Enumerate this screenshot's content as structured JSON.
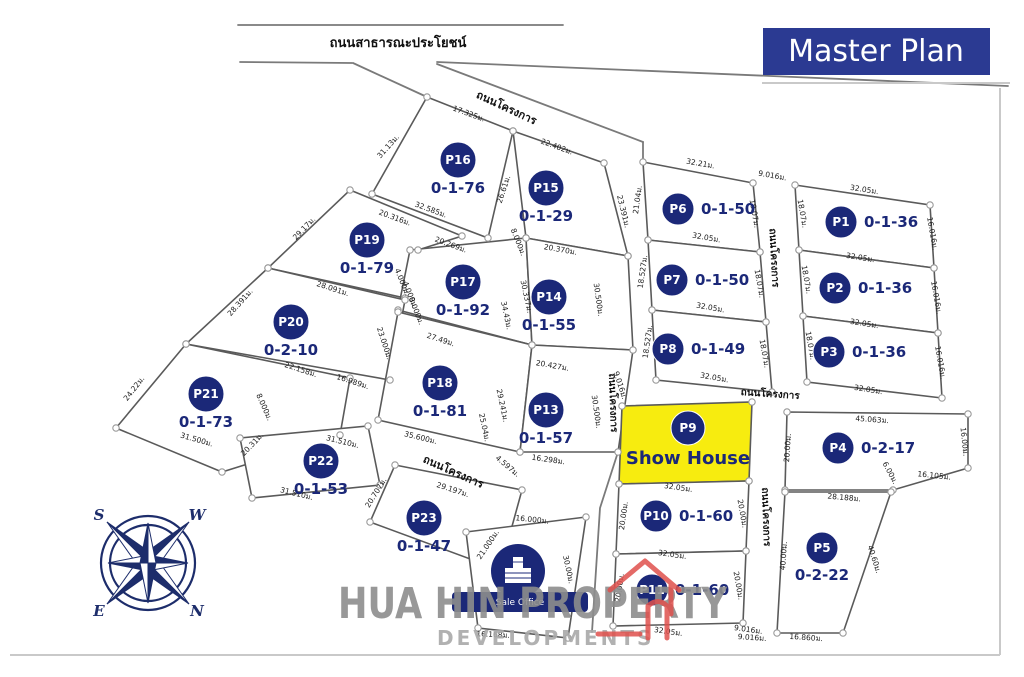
{
  "title": {
    "master_plan": "Master Plan"
  },
  "watermark": {
    "line1": "HUA HIN PROPERTY",
    "line2": "DEVELOPMENTS"
  },
  "sale_office": {
    "label": "Sale Office"
  },
  "compass": {
    "n": "N",
    "s": "S",
    "e": "E",
    "w": "W"
  },
  "colors": {
    "navy": "#1b2878",
    "yellow": "#f7ec0f",
    "box_blue": "#2b3a92",
    "red": "#e0514d"
  },
  "plots": {
    "P1": {
      "id": "P1",
      "area": "0-1-36"
    },
    "P2": {
      "id": "P2",
      "area": "0-1-36"
    },
    "P3": {
      "id": "P3",
      "area": "0-1-36"
    },
    "P4": {
      "id": "P4",
      "area": "0-2-17"
    },
    "P5": {
      "id": "P5",
      "area": "0-2-22"
    },
    "P6": {
      "id": "P6",
      "area": "0-1-50"
    },
    "P7": {
      "id": "P7",
      "area": "0-1-50"
    },
    "P8": {
      "id": "P8",
      "area": "0-1-49"
    },
    "P9": {
      "id": "P9",
      "label": "Show House"
    },
    "P10": {
      "id": "P10",
      "area": "0-1-60"
    },
    "P11": {
      "id": "P11",
      "area": "0-1-60"
    },
    "P13": {
      "id": "P13",
      "area": "0-1-57"
    },
    "P14": {
      "id": "P14",
      "area": "0-1-55"
    },
    "P15": {
      "id": "P15",
      "area": "0-1-29"
    },
    "P16": {
      "id": "P16",
      "area": "0-1-76"
    },
    "P17": {
      "id": "P17",
      "area": "0-1-92"
    },
    "P18": {
      "id": "P18",
      "area": "0-1-81"
    },
    "P19": {
      "id": "P19",
      "area": "0-1-79"
    },
    "P20": {
      "id": "P20",
      "area": "0-2-10"
    },
    "P21": {
      "id": "P21",
      "area": "0-1-73"
    },
    "P22": {
      "id": "P22",
      "area": "0-1-53"
    },
    "P23": {
      "id": "P23",
      "area": "0-1-47"
    }
  },
  "road_labels": [
    {
      "t": "ถนนสาธารณะประโยชน์",
      "x": 398,
      "y": 47,
      "r": 0,
      "s": 13
    },
    {
      "t": "ถนนโครงการ",
      "x": 505,
      "y": 111,
      "r": 25,
      "s": 11
    },
    {
      "t": "ถนนโครงการ",
      "x": 771,
      "y": 258,
      "r": 87,
      "s": 10
    },
    {
      "t": "ถนนโครงการ",
      "x": 610,
      "y": 403,
      "r": 88,
      "s": 10
    },
    {
      "t": "ถนนโครงการ",
      "x": 770,
      "y": 397,
      "r": 4,
      "s": 10
    },
    {
      "t": "ถนนโครงการ",
      "x": 763,
      "y": 517,
      "r": 88,
      "s": 10
    },
    {
      "t": "ถนนโครงการ",
      "x": 452,
      "y": 475,
      "r": 24,
      "s": 11
    }
  ],
  "measurements": [
    {
      "t": "17.325ม.",
      "x": 468,
      "y": 116,
      "r": 20
    },
    {
      "t": "22.402ม.",
      "x": 556,
      "y": 149,
      "r": 20
    },
    {
      "t": "31.13ม.",
      "x": 390,
      "y": 148,
      "r": -48
    },
    {
      "t": "26.61ม.",
      "x": 506,
      "y": 190,
      "r": -72
    },
    {
      "t": "23.391ม.",
      "x": 621,
      "y": 212,
      "r": 76
    },
    {
      "t": "32.585ม.",
      "x": 430,
      "y": 212,
      "r": 20
    },
    {
      "t": "20.316ม.",
      "x": 394,
      "y": 220,
      "r": 20
    },
    {
      "t": "20.269ม.",
      "x": 450,
      "y": 247,
      "r": 20
    },
    {
      "t": "8.000ม.",
      "x": 516,
      "y": 243,
      "r": 68
    },
    {
      "t": "20.370ม.",
      "x": 560,
      "y": 252,
      "r": 10
    },
    {
      "t": "29.17ม.",
      "x": 306,
      "y": 230,
      "r": -46
    },
    {
      "t": "28.091ม.",
      "x": 332,
      "y": 291,
      "r": 18
    },
    {
      "t": "4.000ม.",
      "x": 400,
      "y": 283,
      "r": 68
    },
    {
      "t": "4.000ม.",
      "x": 408,
      "y": 296,
      "r": 68
    },
    {
      "t": "8.000ม.",
      "x": 414,
      "y": 312,
      "r": 68
    },
    {
      "t": "30.337ม.",
      "x": 524,
      "y": 297,
      "r": 78
    },
    {
      "t": "34.43ม.",
      "x": 504,
      "y": 316,
      "r": 78
    },
    {
      "t": "30.500ม.",
      "x": 596,
      "y": 300,
      "r": 82
    },
    {
      "t": "28.391ม.",
      "x": 242,
      "y": 304,
      "r": -48
    },
    {
      "t": "22.158ม.",
      "x": 300,
      "y": 372,
      "r": 18
    },
    {
      "t": "16.989ม.",
      "x": 352,
      "y": 384,
      "r": 18
    },
    {
      "t": "23.000ม.",
      "x": 382,
      "y": 344,
      "r": 72
    },
    {
      "t": "27.49ม.",
      "x": 440,
      "y": 342,
      "r": 18
    },
    {
      "t": "20.427ม.",
      "x": 552,
      "y": 368,
      "r": 10
    },
    {
      "t": "24.22ม.",
      "x": 136,
      "y": 390,
      "r": -52
    },
    {
      "t": "8.000ม.",
      "x": 262,
      "y": 408,
      "r": 66
    },
    {
      "t": "31.500ม.",
      "x": 196,
      "y": 442,
      "r": 16
    },
    {
      "t": "35.600ม.",
      "x": 420,
      "y": 440,
      "r": 14
    },
    {
      "t": "29.241ม.",
      "x": 500,
      "y": 406,
      "r": 78
    },
    {
      "t": "25.04ม.",
      "x": 482,
      "y": 428,
      "r": 78
    },
    {
      "t": "30.500ม.",
      "x": 594,
      "y": 412,
      "r": 82
    },
    {
      "t": "16.298ม.",
      "x": 548,
      "y": 462,
      "r": 8
    },
    {
      "t": "4.597ม.",
      "x": 506,
      "y": 468,
      "r": 40
    },
    {
      "t": "20.31ม.",
      "x": 254,
      "y": 446,
      "r": -46
    },
    {
      "t": "31.510ม.",
      "x": 342,
      "y": 444,
      "r": 14
    },
    {
      "t": "31.510ม.",
      "x": 296,
      "y": 496,
      "r": 14
    },
    {
      "t": "20.707ม.",
      "x": 378,
      "y": 494,
      "r": -58
    },
    {
      "t": "29.197ม.",
      "x": 452,
      "y": 492,
      "r": 18
    },
    {
      "t": "21.000ม.",
      "x": 490,
      "y": 546,
      "r": -56
    },
    {
      "t": "16.000ม.",
      "x": 532,
      "y": 522,
      "r": 6
    },
    {
      "t": "30.00ม.",
      "x": 566,
      "y": 570,
      "r": 78
    },
    {
      "t": "16.168ม.",
      "x": 493,
      "y": 637,
      "r": 3
    },
    {
      "t": "32.21ม.",
      "x": 700,
      "y": 166,
      "r": 10
    },
    {
      "t": "21.04ม.",
      "x": 640,
      "y": 200,
      "r": -82
    },
    {
      "t": "18.07ม.",
      "x": 752,
      "y": 214,
      "r": 80
    },
    {
      "t": "32.05ม.",
      "x": 706,
      "y": 240,
      "r": 10
    },
    {
      "t": "9.016ม.",
      "x": 772,
      "y": 178,
      "r": 10
    },
    {
      "t": "18.07ม.",
      "x": 800,
      "y": 214,
      "r": 80
    },
    {
      "t": "32.05ม.",
      "x": 864,
      "y": 192,
      "r": 9
    },
    {
      "t": "16.016ม.",
      "x": 930,
      "y": 234,
      "r": 80
    },
    {
      "t": "32.05ม.",
      "x": 860,
      "y": 260,
      "r": 9
    },
    {
      "t": "18.07ม.",
      "x": 804,
      "y": 280,
      "r": 80
    },
    {
      "t": "16.016ม.",
      "x": 934,
      "y": 298,
      "r": 80
    },
    {
      "t": "32.05ม.",
      "x": 864,
      "y": 326,
      "r": 9
    },
    {
      "t": "18.07ม.",
      "x": 808,
      "y": 346,
      "r": 80
    },
    {
      "t": "16.016ม.",
      "x": 938,
      "y": 363,
      "r": 80
    },
    {
      "t": "32.05ม.",
      "x": 868,
      "y": 392,
      "r": 9
    },
    {
      "t": "18.527ม.",
      "x": 645,
      "y": 272,
      "r": -82
    },
    {
      "t": "18.07ม.",
      "x": 757,
      "y": 284,
      "r": 80
    },
    {
      "t": "32.05ม.",
      "x": 710,
      "y": 310,
      "r": 10
    },
    {
      "t": "18.527ม.",
      "x": 650,
      "y": 342,
      "r": -82
    },
    {
      "t": "18.07ม.",
      "x": 762,
      "y": 354,
      "r": 80
    },
    {
      "t": "32.05ม.",
      "x": 714,
      "y": 380,
      "r": 10
    },
    {
      "t": "9.016ม.",
      "x": 618,
      "y": 386,
      "r": 72
    },
    {
      "t": "32.05ม.",
      "x": 678,
      "y": 490,
      "r": 8
    },
    {
      "t": "20.00ม.",
      "x": 626,
      "y": 516,
      "r": -82
    },
    {
      "t": "20.00ม.",
      "x": 740,
      "y": 514,
      "r": 80
    },
    {
      "t": "32.05ม.",
      "x": 672,
      "y": 557,
      "r": 8
    },
    {
      "t": "20.00ม.",
      "x": 622,
      "y": 588,
      "r": -82
    },
    {
      "t": "20.00ม.",
      "x": 736,
      "y": 586,
      "r": 80
    },
    {
      "t": "32.05ม.",
      "x": 668,
      "y": 634,
      "r": 8
    },
    {
      "t": "9.016ม.",
      "x": 748,
      "y": 632,
      "r": 8
    },
    {
      "t": "45.063ม.",
      "x": 872,
      "y": 422,
      "r": 4
    },
    {
      "t": "20.00ม.",
      "x": 790,
      "y": 448,
      "r": -86
    },
    {
      "t": "16.00ม.",
      "x": 962,
      "y": 442,
      "r": 84
    },
    {
      "t": "16.105ม.",
      "x": 934,
      "y": 478,
      "r": 6
    },
    {
      "t": "6.00ม.",
      "x": 888,
      "y": 474,
      "r": 62
    },
    {
      "t": "28.188ม.",
      "x": 844,
      "y": 500,
      "r": 5
    },
    {
      "t": "40.00ม.",
      "x": 786,
      "y": 556,
      "r": -86
    },
    {
      "t": "40.60ม.",
      "x": 872,
      "y": 560,
      "r": 72
    },
    {
      "t": "16.860ม.",
      "x": 806,
      "y": 640,
      "r": 4
    },
    {
      "t": "9.016ม.",
      "x": 752,
      "y": 640,
      "r": 4
    }
  ]
}
